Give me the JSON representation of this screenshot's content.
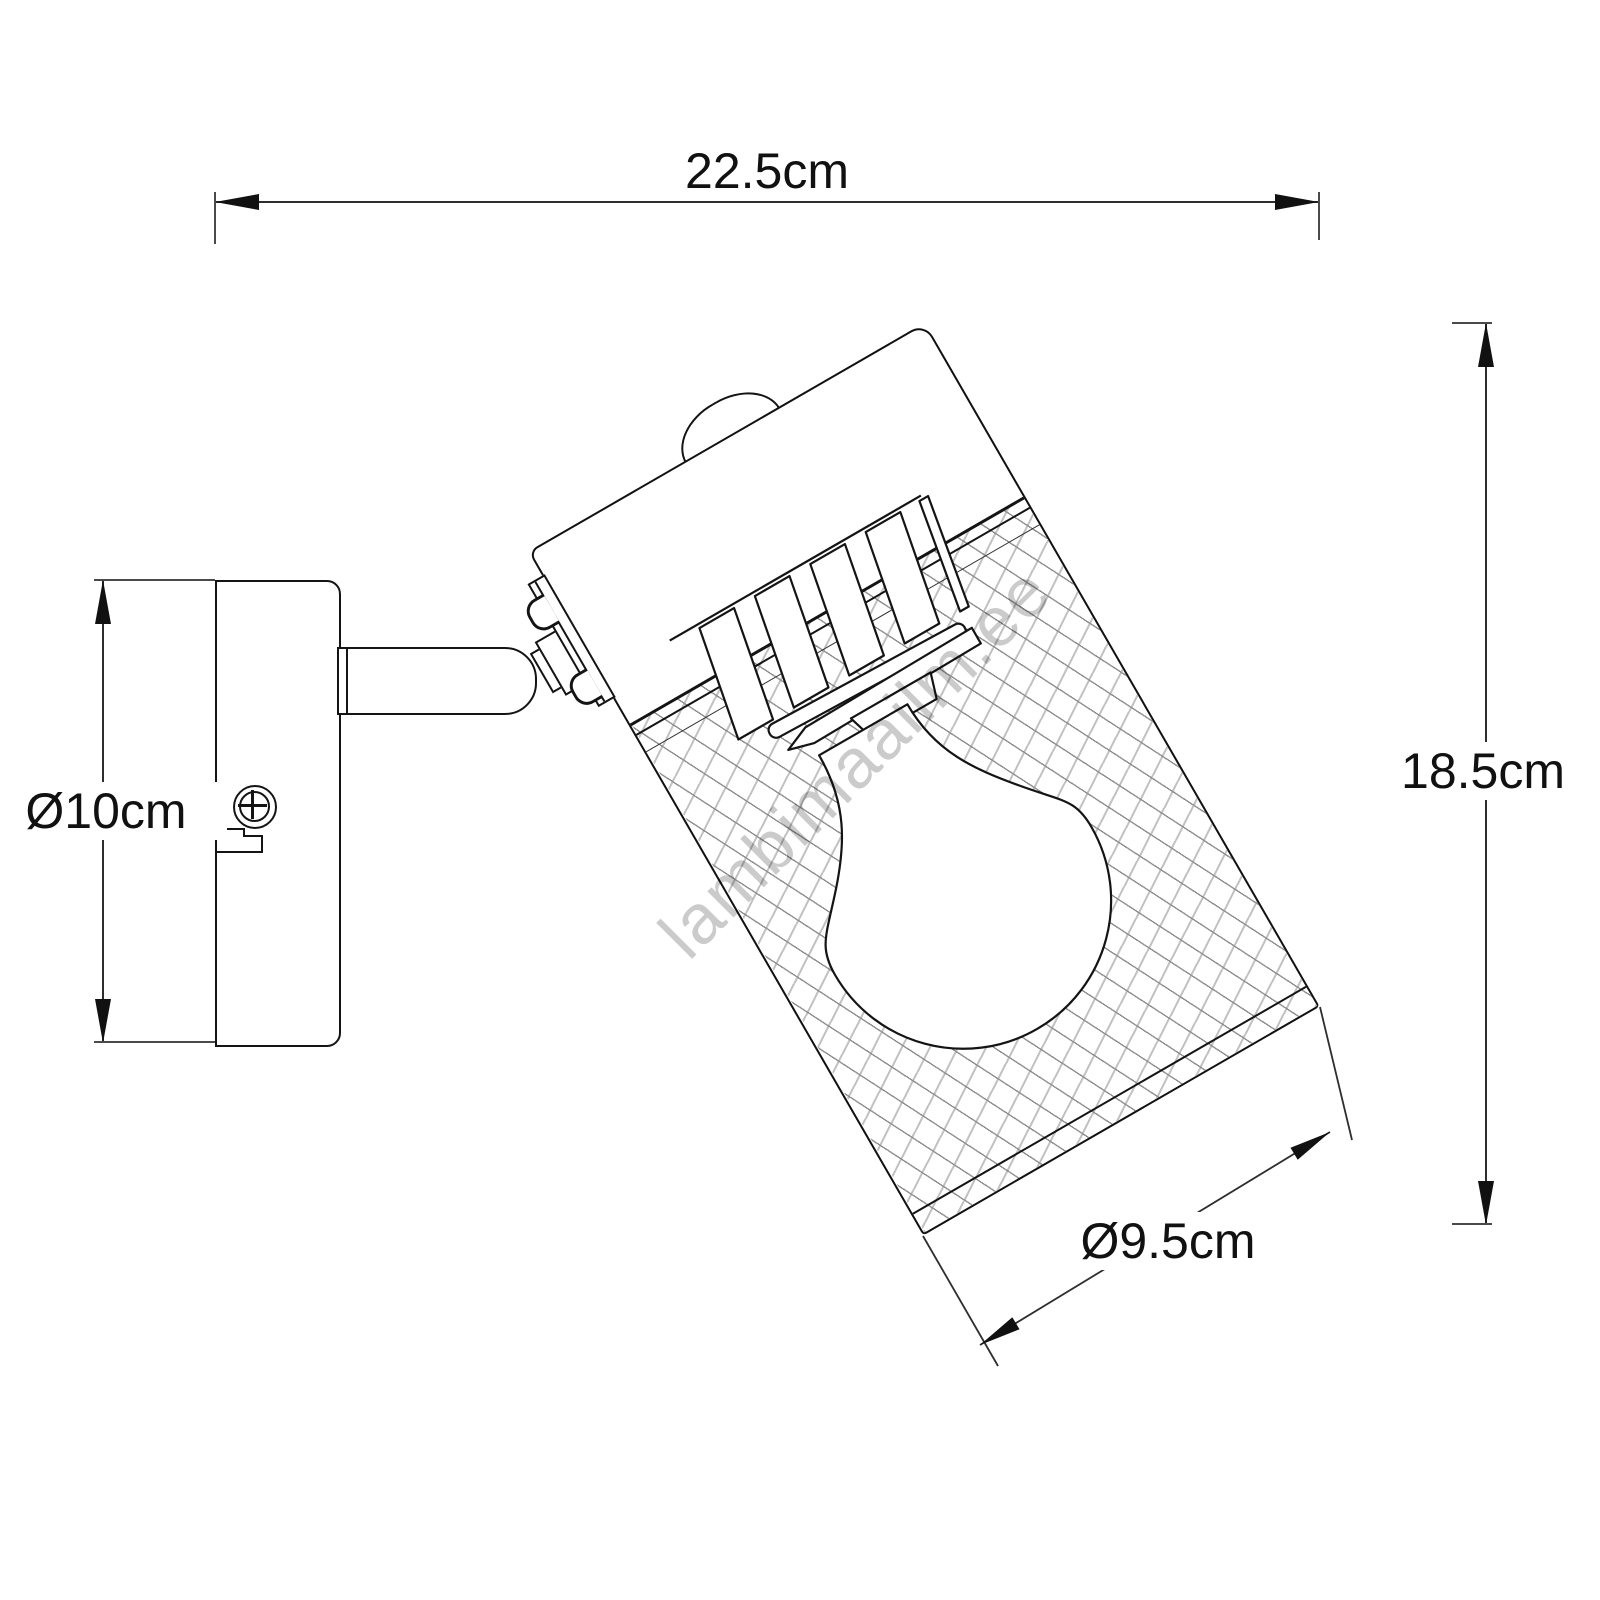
{
  "drawing_title": "wall spotlight technical dimension drawing",
  "watermark": {
    "text": "lambimaailm.ee",
    "color": "#cbcbcb"
  },
  "dimensions": {
    "overall_width": {
      "label": "22.5cm",
      "value_cm": 22.5,
      "orientation": "horizontal-top"
    },
    "overall_height": {
      "label": "18.5cm",
      "value_cm": 18.5,
      "orientation": "vertical-right"
    },
    "base_diameter": {
      "label": "Ø10cm",
      "value_cm": 10,
      "orientation": "vertical-left"
    },
    "shade_diameter": {
      "label": "Ø9.5cm",
      "value_cm": 9.5,
      "orientation": "diagonal-bottom"
    }
  },
  "colors": {
    "outline": "#141414",
    "dimension_line": "#2e2e2e",
    "mesh_line_dark": "#8f8f8f",
    "mesh_line_light": "#c2c2c2",
    "background": "#ffffff"
  },
  "components": {
    "wall_plate": "round wall mount plate with screw",
    "arm": "pivot arm with swivel joint",
    "shade": "tilted cylindrical mesh shade",
    "bulb": "E27 light bulb inside shade"
  }
}
